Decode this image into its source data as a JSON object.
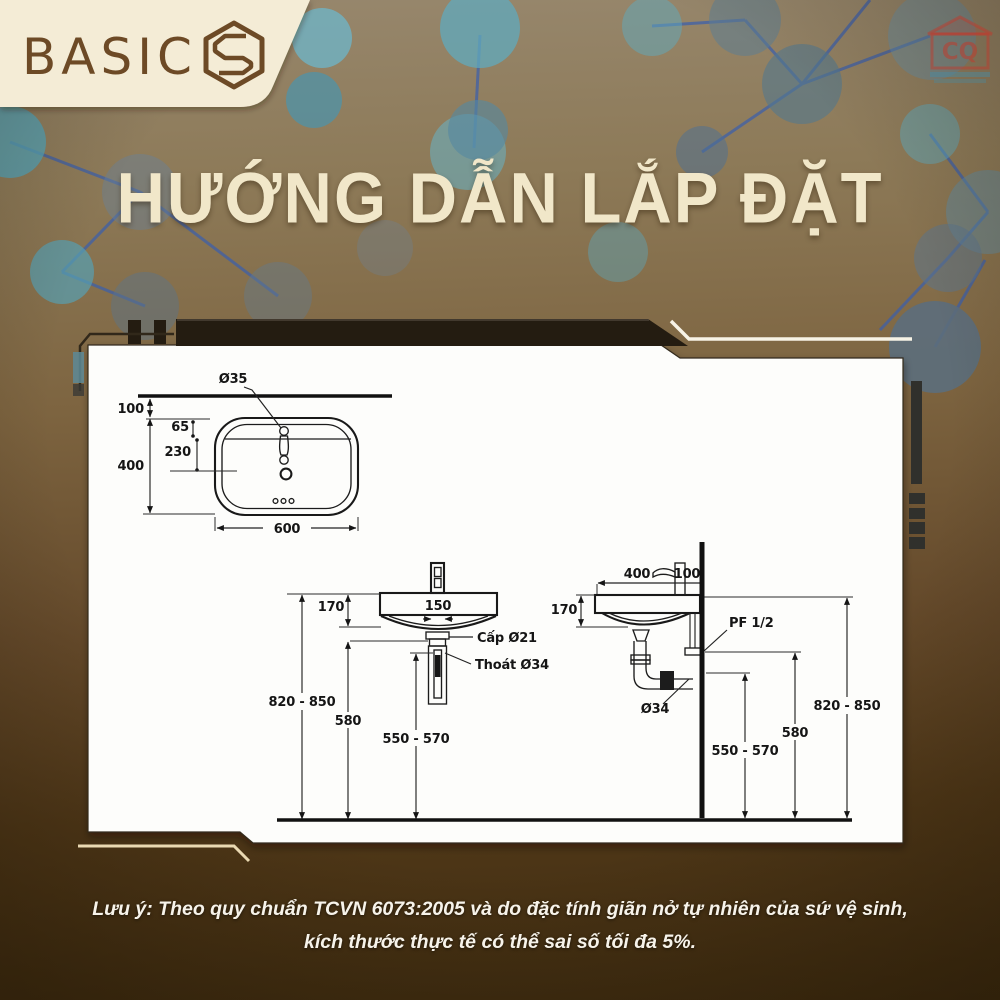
{
  "brand": {
    "name": "BASIC",
    "icon": "hexagon-s-icon"
  },
  "watermark": {
    "text": "CQ"
  },
  "title": "HƯỚNG DẪN LẮP ĐẶT",
  "note": {
    "line1": "Lưu ý: Theo quy chuẩn TCVN 6073:2005 và do đặc tính giãn nở tự nhiên của sứ vệ sinh,",
    "line2": "kích thước thực tế có thể sai số tối đa 5%."
  },
  "colors": {
    "background_top": "#97876d",
    "background_bottom": "#3f2c10",
    "accent_cream": "#f2e8cc",
    "logo_brown": "#6d4a26",
    "panel_white": "#fdfdfb",
    "teal_node": "#5da4b8",
    "steel_node": "#54788e",
    "link_blue": "#3a5fae"
  },
  "diagram": {
    "top_view": {
      "hole_dia": "Ø35",
      "wall_offset": "100",
      "hole_offset": "65",
      "drain_offset": "230",
      "depth": "400",
      "width": "600"
    },
    "front_view": {
      "thickness": "170",
      "drain_span": "150",
      "supply_label": "Cấp Ø21",
      "drain_label": "Thoát Ø34",
      "rim_height": "820 - 850",
      "supply_height": "580",
      "drain_height": "550 - 570"
    },
    "side_view": {
      "depth": "400",
      "faucet_gap": "100",
      "thickness": "170",
      "wall_fitting": "PF 1/2",
      "drain_dia": "Ø34",
      "rim_height": "820 - 850",
      "supply_height": "580",
      "drain_height": "550 - 570"
    }
  }
}
